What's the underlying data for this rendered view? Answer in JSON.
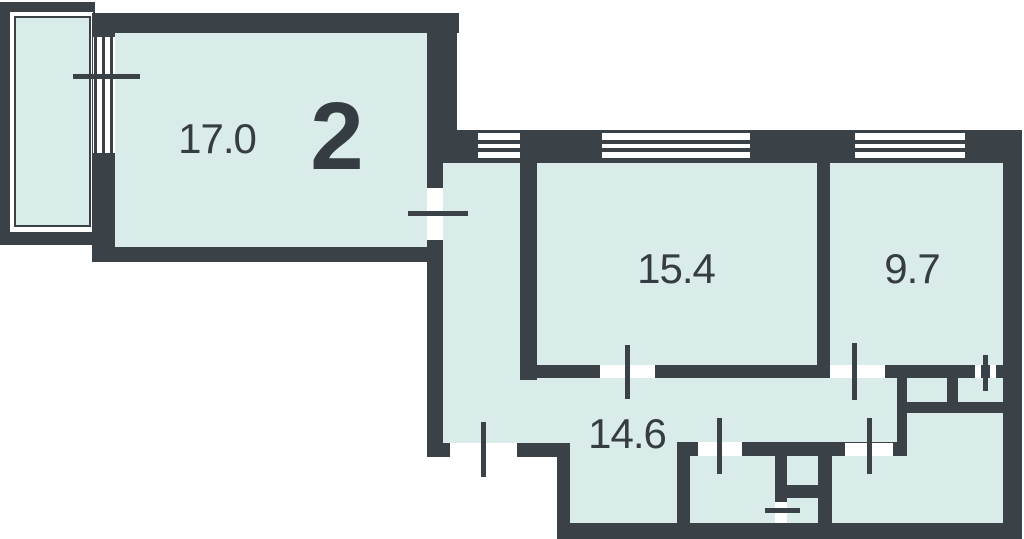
{
  "plan": {
    "rooms_count_label": "2",
    "rooms": [
      {
        "name": "room-1",
        "area_label": "17.0"
      },
      {
        "name": "room-2",
        "area_label": "15.4"
      },
      {
        "name": "kitchen",
        "area_label": "9.7"
      },
      {
        "name": "hallway",
        "area_label": "14.6"
      }
    ],
    "symbols": [
      "balcony",
      "windows",
      "door-openings",
      "door-marks"
    ]
  },
  "colors": {
    "wall": "#3b4247",
    "room_fill": "#d9ece9",
    "background": "#ffffff",
    "label": "#363d42"
  }
}
